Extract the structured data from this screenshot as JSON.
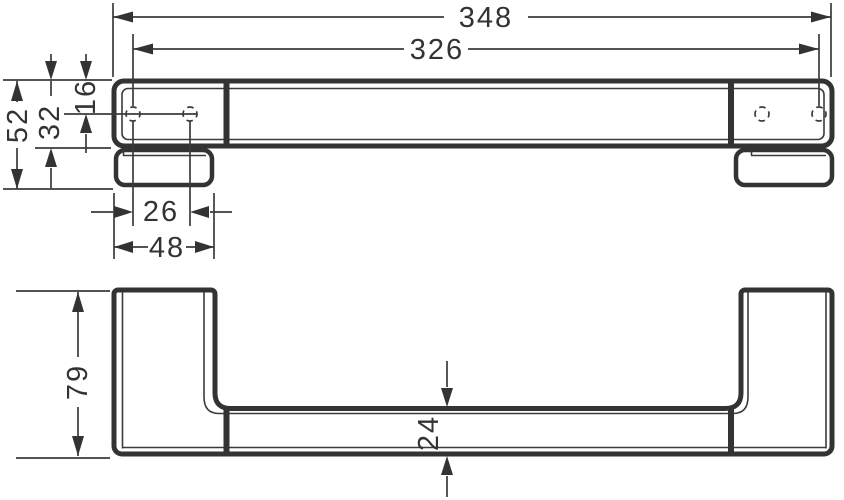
{
  "dimensions": {
    "front_view": {
      "overall_length": "348",
      "hole_span": "326",
      "total_height": "52",
      "body_height": "32",
      "edge_to_hole_axis": "16",
      "hole_pitch": "26",
      "plate_width": "48"
    },
    "plan_view": {
      "depth": "79",
      "bar_thickness": "24"
    }
  },
  "colors": {
    "line": "#333333",
    "thin_line": "#3b3b3b",
    "background": "#ffffff"
  }
}
